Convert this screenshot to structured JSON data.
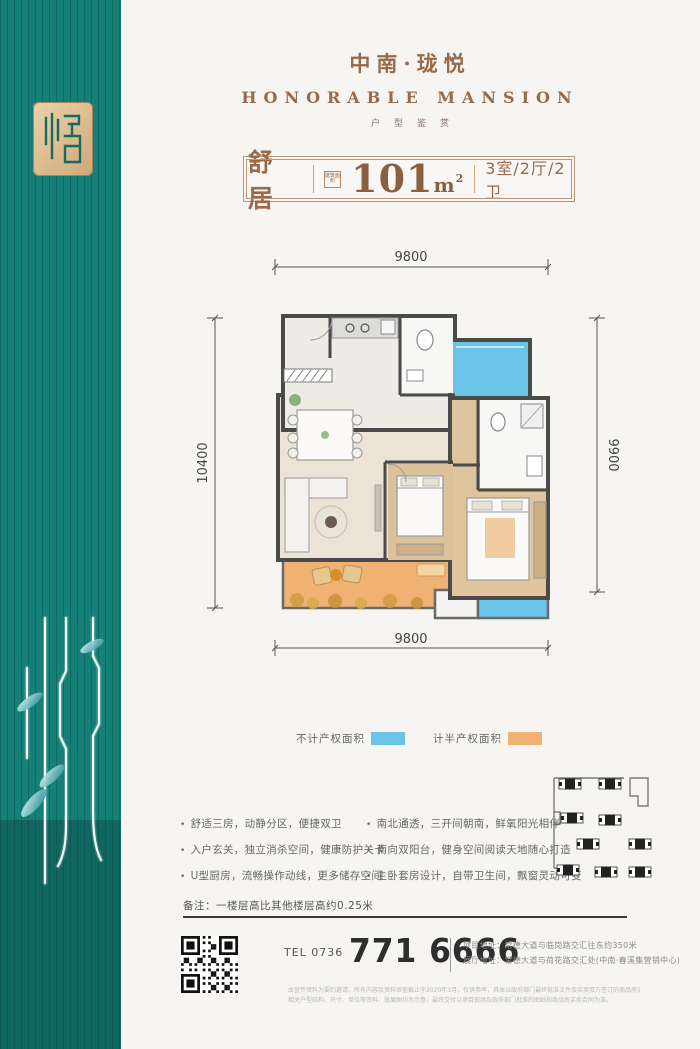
{
  "brand": {
    "title": "中南·珑悦",
    "subtitle": "HONORABLE  MANSION",
    "tagline": "户型鉴赏"
  },
  "unit": {
    "name": "舒居",
    "area_chip": "建筑面积",
    "area_value": "101",
    "area_unit": "m",
    "area_sup": "2",
    "rooms": "3室/2厅/2卫"
  },
  "floorplan": {
    "dim_top": "9800",
    "dim_bottom": "9800",
    "dim_left": "10400",
    "dim_right": "9900"
  },
  "legend": {
    "items": [
      {
        "label": "不计产权面积",
        "color": "#6ac4e8"
      },
      {
        "label": "计半产权面积",
        "color": "#f0b273"
      }
    ]
  },
  "features": {
    "left": [
      "舒适三房，动静分区，便捷双卫",
      "入户玄关，独立消杀空间，健康防护关卡",
      "U型厨房，流畅操作动线，更多储存空间"
    ],
    "right": [
      "南北通透，三开间朝南，鲜氧阳光相伴",
      "南向双阳台，健身空间阅读天地随心打造",
      "主卧套房设计，自带卫生间，飘窗灵动可变"
    ]
  },
  "note": "备注：一楼层高比其他楼层高约0.25米",
  "contact": {
    "tel_label": "TEL 0736",
    "phone": "771 6666",
    "address1": "项目地址：常德大道与临岗路交汇往东约350米",
    "address2": "展厅地址：常德大道与荷花路交汇处(中南·春溪集营销中心)",
    "disclaimer1": "本宣传资料为要约邀请，所有内容及资料审查截止于2020年3月，仅供参考，具体以政府部门最终批准文件及买卖双方签订的商品房买卖合同为准，相关面积均为建筑面积。",
    "disclaimer2": "相关户型结构、尺寸、单位等资料、效果图均为示意，最终交付以项目现场及政府部门批准的图纸和商品房买卖合同为准。"
  },
  "colors": {
    "sidebar_teal": "#148078",
    "brand_brown": "#9a6a48",
    "no_property_area_blue": "#6ac4e8",
    "half_property_area_orange": "#f0b273"
  }
}
